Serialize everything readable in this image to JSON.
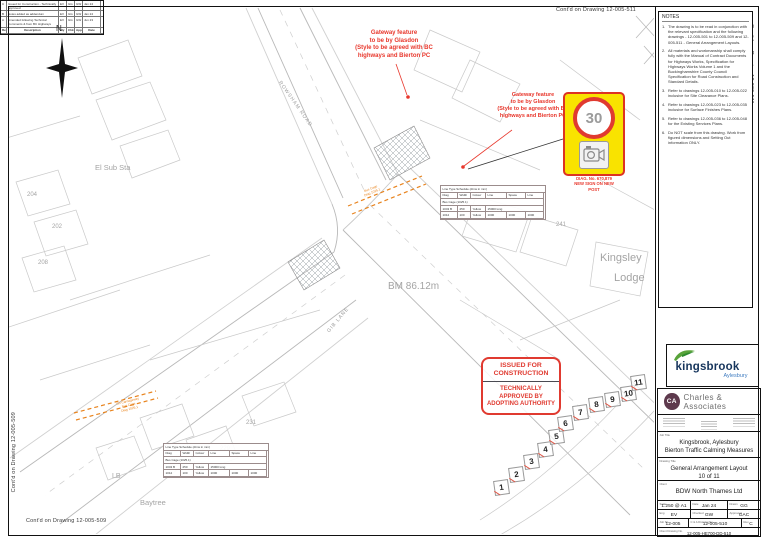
{
  "edge": {
    "top": "Cont'd on Drawing 12-005-511",
    "right": "Cont'd on Drawing 12-005-511",
    "left": "Cont'd on Drawing 12-005-509",
    "bottom": "Cont'd on Drawing 12-005-509"
  },
  "notes": {
    "title": "NOTES",
    "items": [
      {
        "n": "1.",
        "t": "The drawing is to be read in conjunction with the relevant specification and the following drawings - 12-005-501 to 12-005-509 and 12-005-511 - General Arrangement Layouts."
      },
      {
        "n": "2.",
        "t": "All materials and workmanship shall comply fully with the Manual of Contract Documents for Highways Works, Specification for Highways Works Volume 1 and the Buckinghamshire County Council Specification for Road Construction and Standard Details."
      },
      {
        "n": "3.",
        "t": "Refer to drawings 12-005-010 to 12-005-022 inclusive for Site Clearance Plans."
      },
      {
        "n": "4.",
        "t": "Refer to drawings 12-005-023 to 12-005-035 inclusive for Surface Finishes Plans."
      },
      {
        "n": "5.",
        "t": "Refer to drawings 12-005-036 to 12-005-048 for the Existing Services Plans."
      },
      {
        "n": "6.",
        "t": "Do NOT scale from this drawing. Work from figured dimensions and Setting Out information ONLY."
      }
    ]
  },
  "revisions": {
    "rows": [
      {
        "rev": "C",
        "desc": "Issued for Construction - Technically approved",
        "by": "EV",
        "chk": "GG",
        "app": "GW",
        "date": "Jan 24"
      },
      {
        "rev": "B",
        "desc": "Notes added as addendum",
        "by": "EV",
        "chk": "GG",
        "app": "GW",
        "date": "Jan 24"
      },
      {
        "rev": "A",
        "desc": "Amended following Technical Comments & from BC Highways",
        "by": "EV",
        "chk": "GG",
        "app": "GW",
        "date": "Jun 23"
      }
    ],
    "header": {
      "rev": "Rev",
      "desc": "Description",
      "by": "By",
      "chk": "Chk",
      "app": "App",
      "date": "Date"
    }
  },
  "brand": {
    "kingsbrook": "kingsbrook",
    "place": "Aylesbury"
  },
  "titleblock": {
    "company": "Charles & Associates",
    "initials": "CA",
    "job_title_label": "Job Title",
    "job_title": "Kingsbrook, Aylesbury\nBierton Traffic Calming Measures",
    "drawing_title_label": "Drawing Title",
    "drawing_title": "General Arrangement Layout\n10 of 11",
    "client_label": "Client",
    "client": "BDW North Thames Ltd",
    "scale_label": "Scale",
    "scale": "1:250 @ A1",
    "date_label": "Date",
    "date": "Jan 24",
    "drawn_label": "Drawn",
    "drawn": "GG",
    "eng_label": "Eng",
    "eng": "EV",
    "checked_label": "Checked",
    "checked": "GW",
    "approved_label": "Approved",
    "approved": "GAC",
    "job_label": "Job No.",
    "job": "12-005",
    "dwg_label": "C & A Drawing No.",
    "dwg": "12-005-510",
    "rev_label": "Rev.",
    "rev": "C",
    "client_dwg_label": "Client Drawing No.",
    "client_dwg": "12-005-HE700-DD-510"
  },
  "stamp": {
    "top": "ISSUED FOR\nCONSTRUCTION",
    "bottom": "TECHNICALLY\nAPPROVED BY\nADOPTING AUTHORITY"
  },
  "annotations": {
    "gateway1": "Gateway feature\nto be by Glasdon\n(Style to be agreed with BC\nhighways and Bierton PC",
    "gateway2": "Gateway feature\nto be by Glasdon\n(Style to be agreed with BC\nhighways and Bierton PC",
    "sign_speed": "30",
    "sign_caption": "DIAG. No. 670,879\nNEW SIGN ON NEW\nPOST"
  },
  "schedule": {
    "title": "Line Type Schedule (dims in mm)",
    "h": [
      "Diag",
      "Width",
      "Colour",
      "Line",
      "Space",
      "Line"
    ],
    "group": "Bus Cage (1025.1)",
    "r1": [
      "1043 B",
      "250",
      "Yellow",
      "15000 long"
    ],
    "r2": [
      "1012",
      "100",
      "Yellow",
      "1000",
      "1000",
      "1000"
    ]
  },
  "map": {
    "north": "N",
    "road1": "ROWSHAM ROAD",
    "road2": "GIB LANE",
    "bm": "BM 86.12m",
    "el_sub": "El Sub Sta",
    "kingsley": "Kingsley",
    "lodge": "Lodge",
    "lb": "LB",
    "baytree": "Baytree",
    "n204": "204",
    "n202": "202",
    "n208": "208",
    "n241": "241",
    "n231": "231",
    "n229": "229",
    "buscage1": "Bus Cage\nDiag 1025.1",
    "buscage2": "On Carriageway\nBus Cage\nDiag 1025.1"
  },
  "plots": [
    "1",
    "2",
    "3",
    "4",
    "5",
    "6",
    "7",
    "8",
    "9",
    "10",
    "11"
  ],
  "colors": {
    "annotation_red": "#e8372c",
    "marking_orange": "#e8831d",
    "sign_yellow": "#f9e300",
    "brand_green": "#58a33a",
    "brand_navy": "#16355c"
  }
}
